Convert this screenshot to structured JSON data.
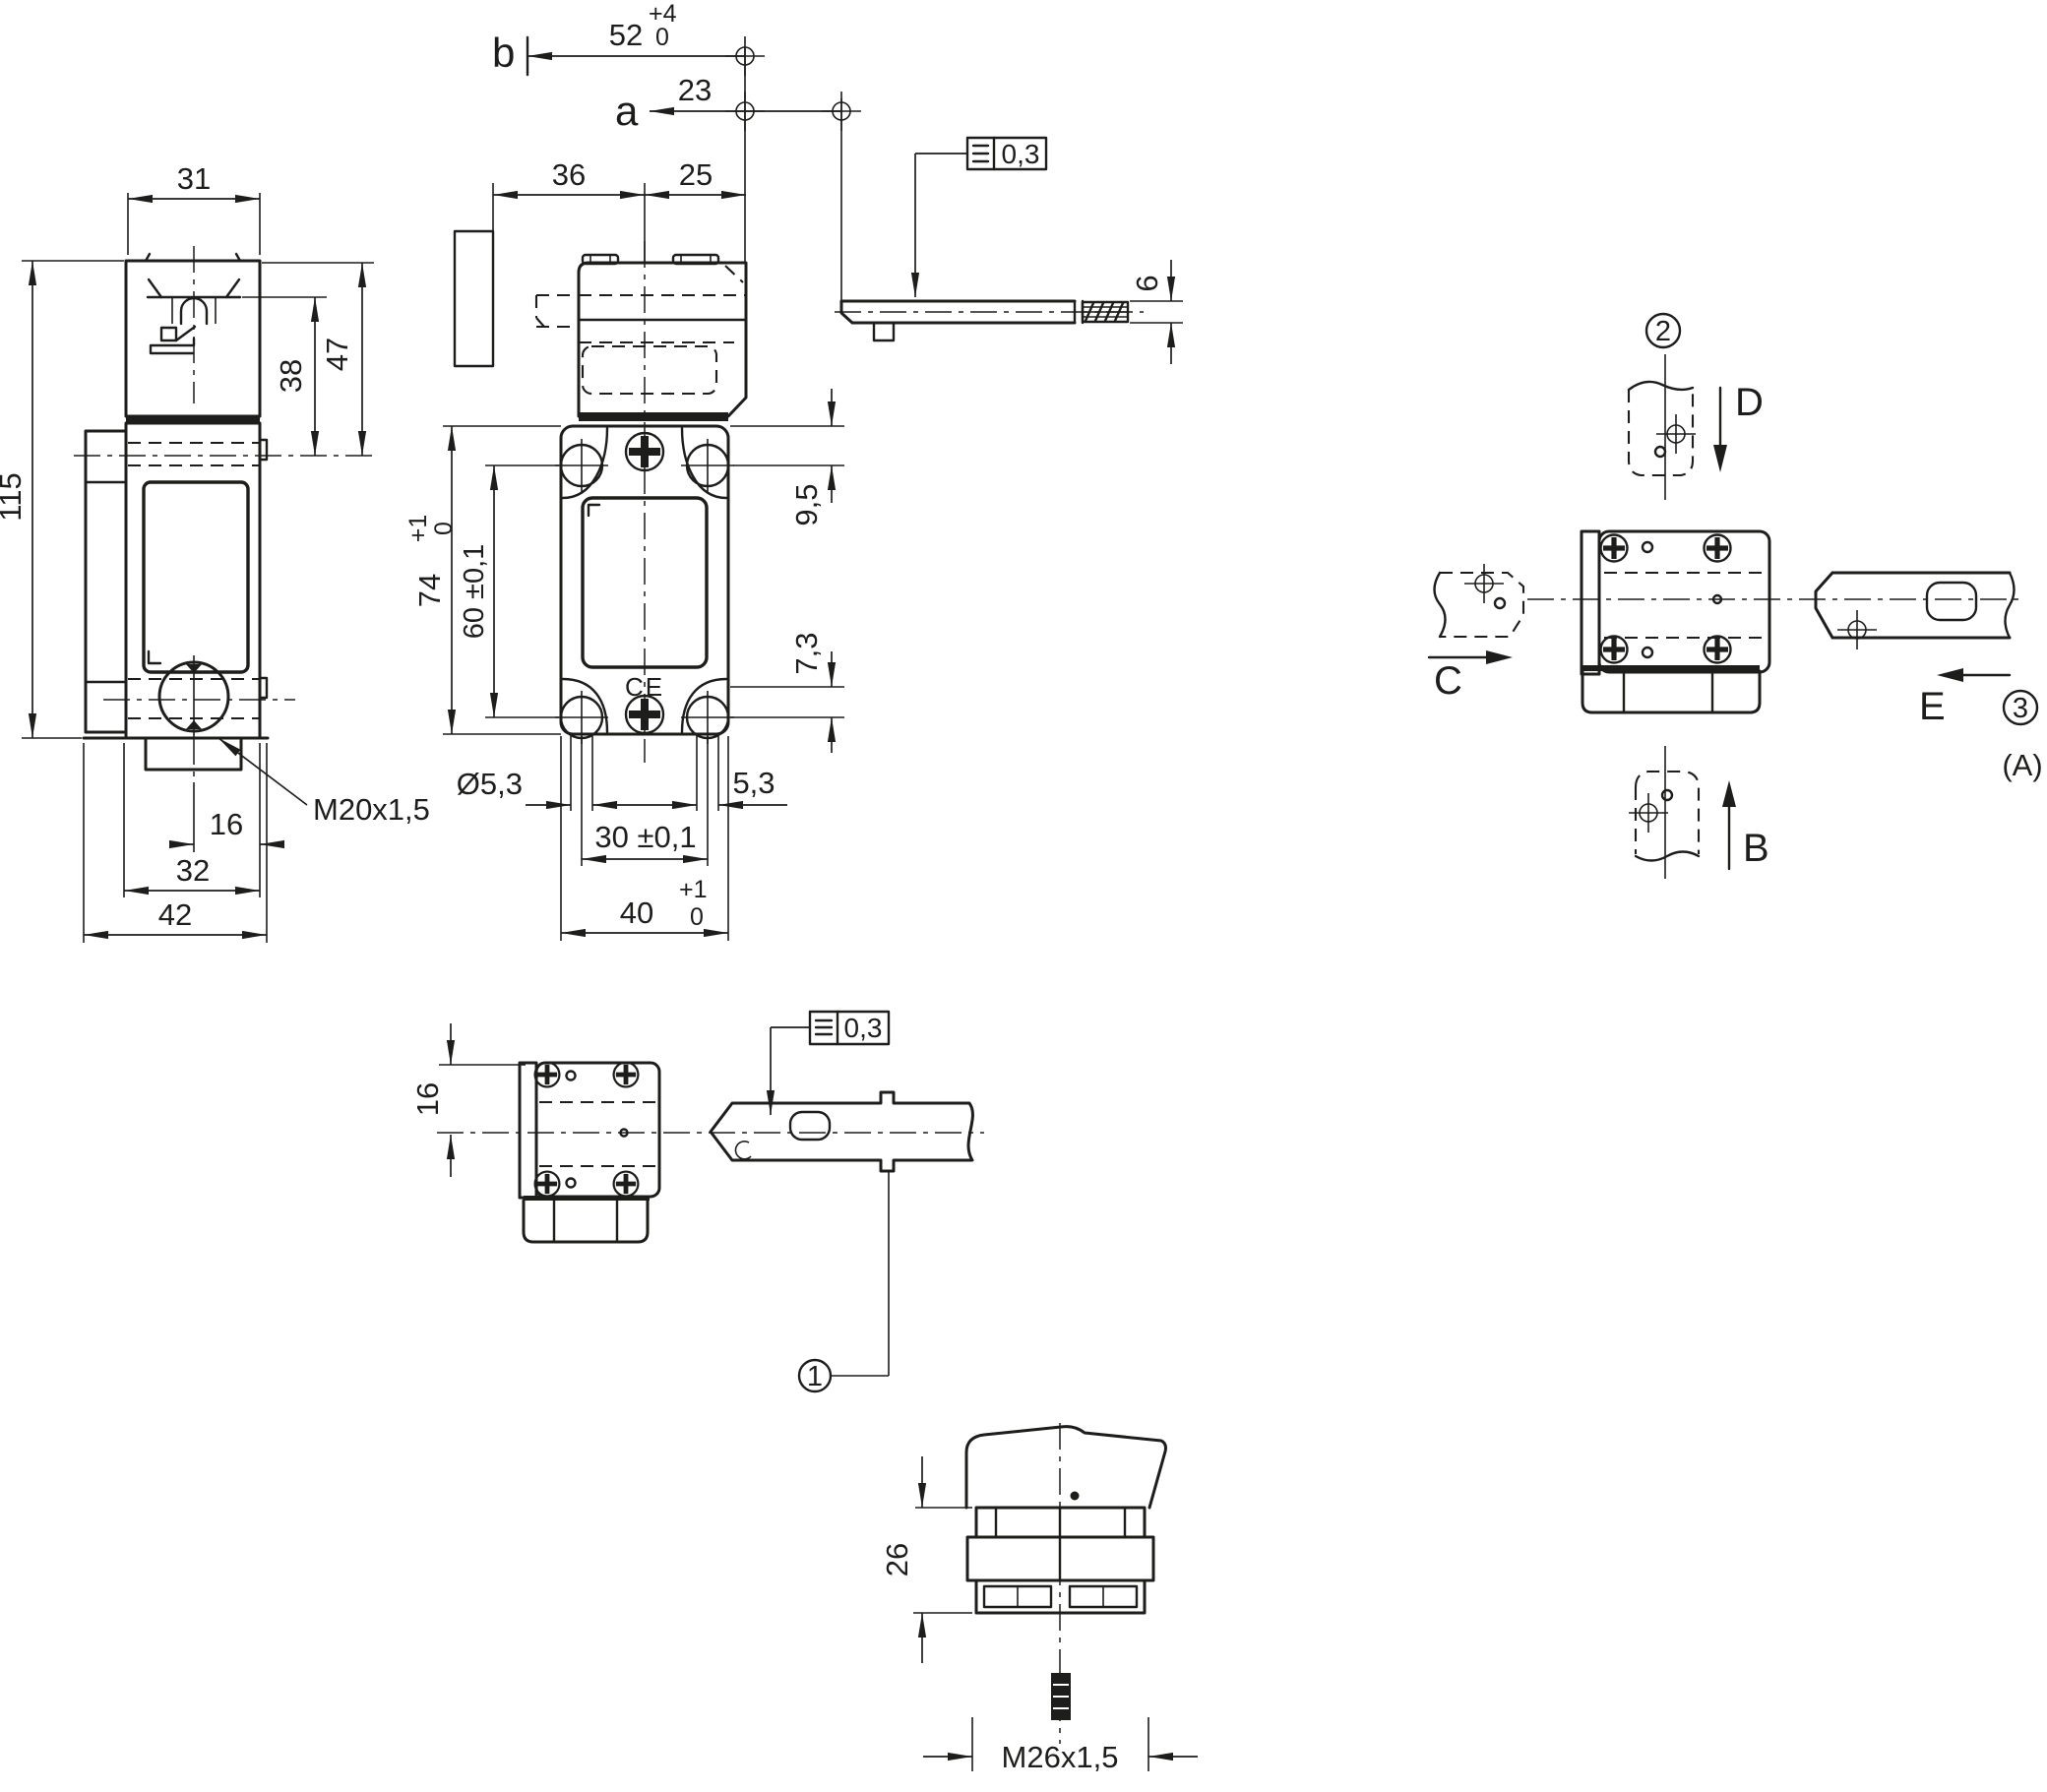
{
  "colors": {
    "ink": "#1d1d1b",
    "background": "#ffffff"
  },
  "side_view": {
    "dim_head_width": "31",
    "dim_head_height": "47",
    "dim_lever_height": "38",
    "dim_total_height": "115",
    "thread_label": "M20x1,5",
    "dim_gland_offset": "16",
    "dim_body_width": "32",
    "dim_total_width": "42"
  },
  "front_view": {
    "label_b": "b",
    "dim_travel_b": "52",
    "dim_travel_b_tol_upper": "+4",
    "dim_travel_b_tol_lower": "0",
    "label_a": "a",
    "dim_travel_a": "23",
    "dim_wall_to_center": "36",
    "dim_center_to_face": "25",
    "dim_hole_top_offset": "9,5",
    "dim_body_height": "74",
    "dim_body_height_tol_upper": "+1",
    "dim_body_height_tol_lower": "0",
    "dim_hole_pitch_vertical": "60 ±0,1",
    "dim_hole_bottom_offset": "7,3",
    "dim_hole_diameter": "Ø5,3",
    "dim_slot_width": "5,3",
    "dim_hole_pitch_horizontal": "30 ±0,1",
    "dim_body_width": "40",
    "dim_body_width_tol_upper": "+1",
    "dim_body_width_tol_lower": "0",
    "ce_mark": "CE"
  },
  "actuator_side_view": {
    "tolerance_value": "0,3",
    "dim_thickness": "6"
  },
  "top_view": {
    "dim_half_height": "16",
    "tolerance_value": "0,3",
    "callout_1": "1"
  },
  "orientation_view": {
    "callout_2": "2",
    "callout_3": "3",
    "ref_a": "(A)",
    "dir_b": "B",
    "dir_c": "C",
    "dir_d": "D",
    "dir_e": "E"
  },
  "connector_view": {
    "dim_depth": "26",
    "thread_label": "M26x1,5"
  }
}
